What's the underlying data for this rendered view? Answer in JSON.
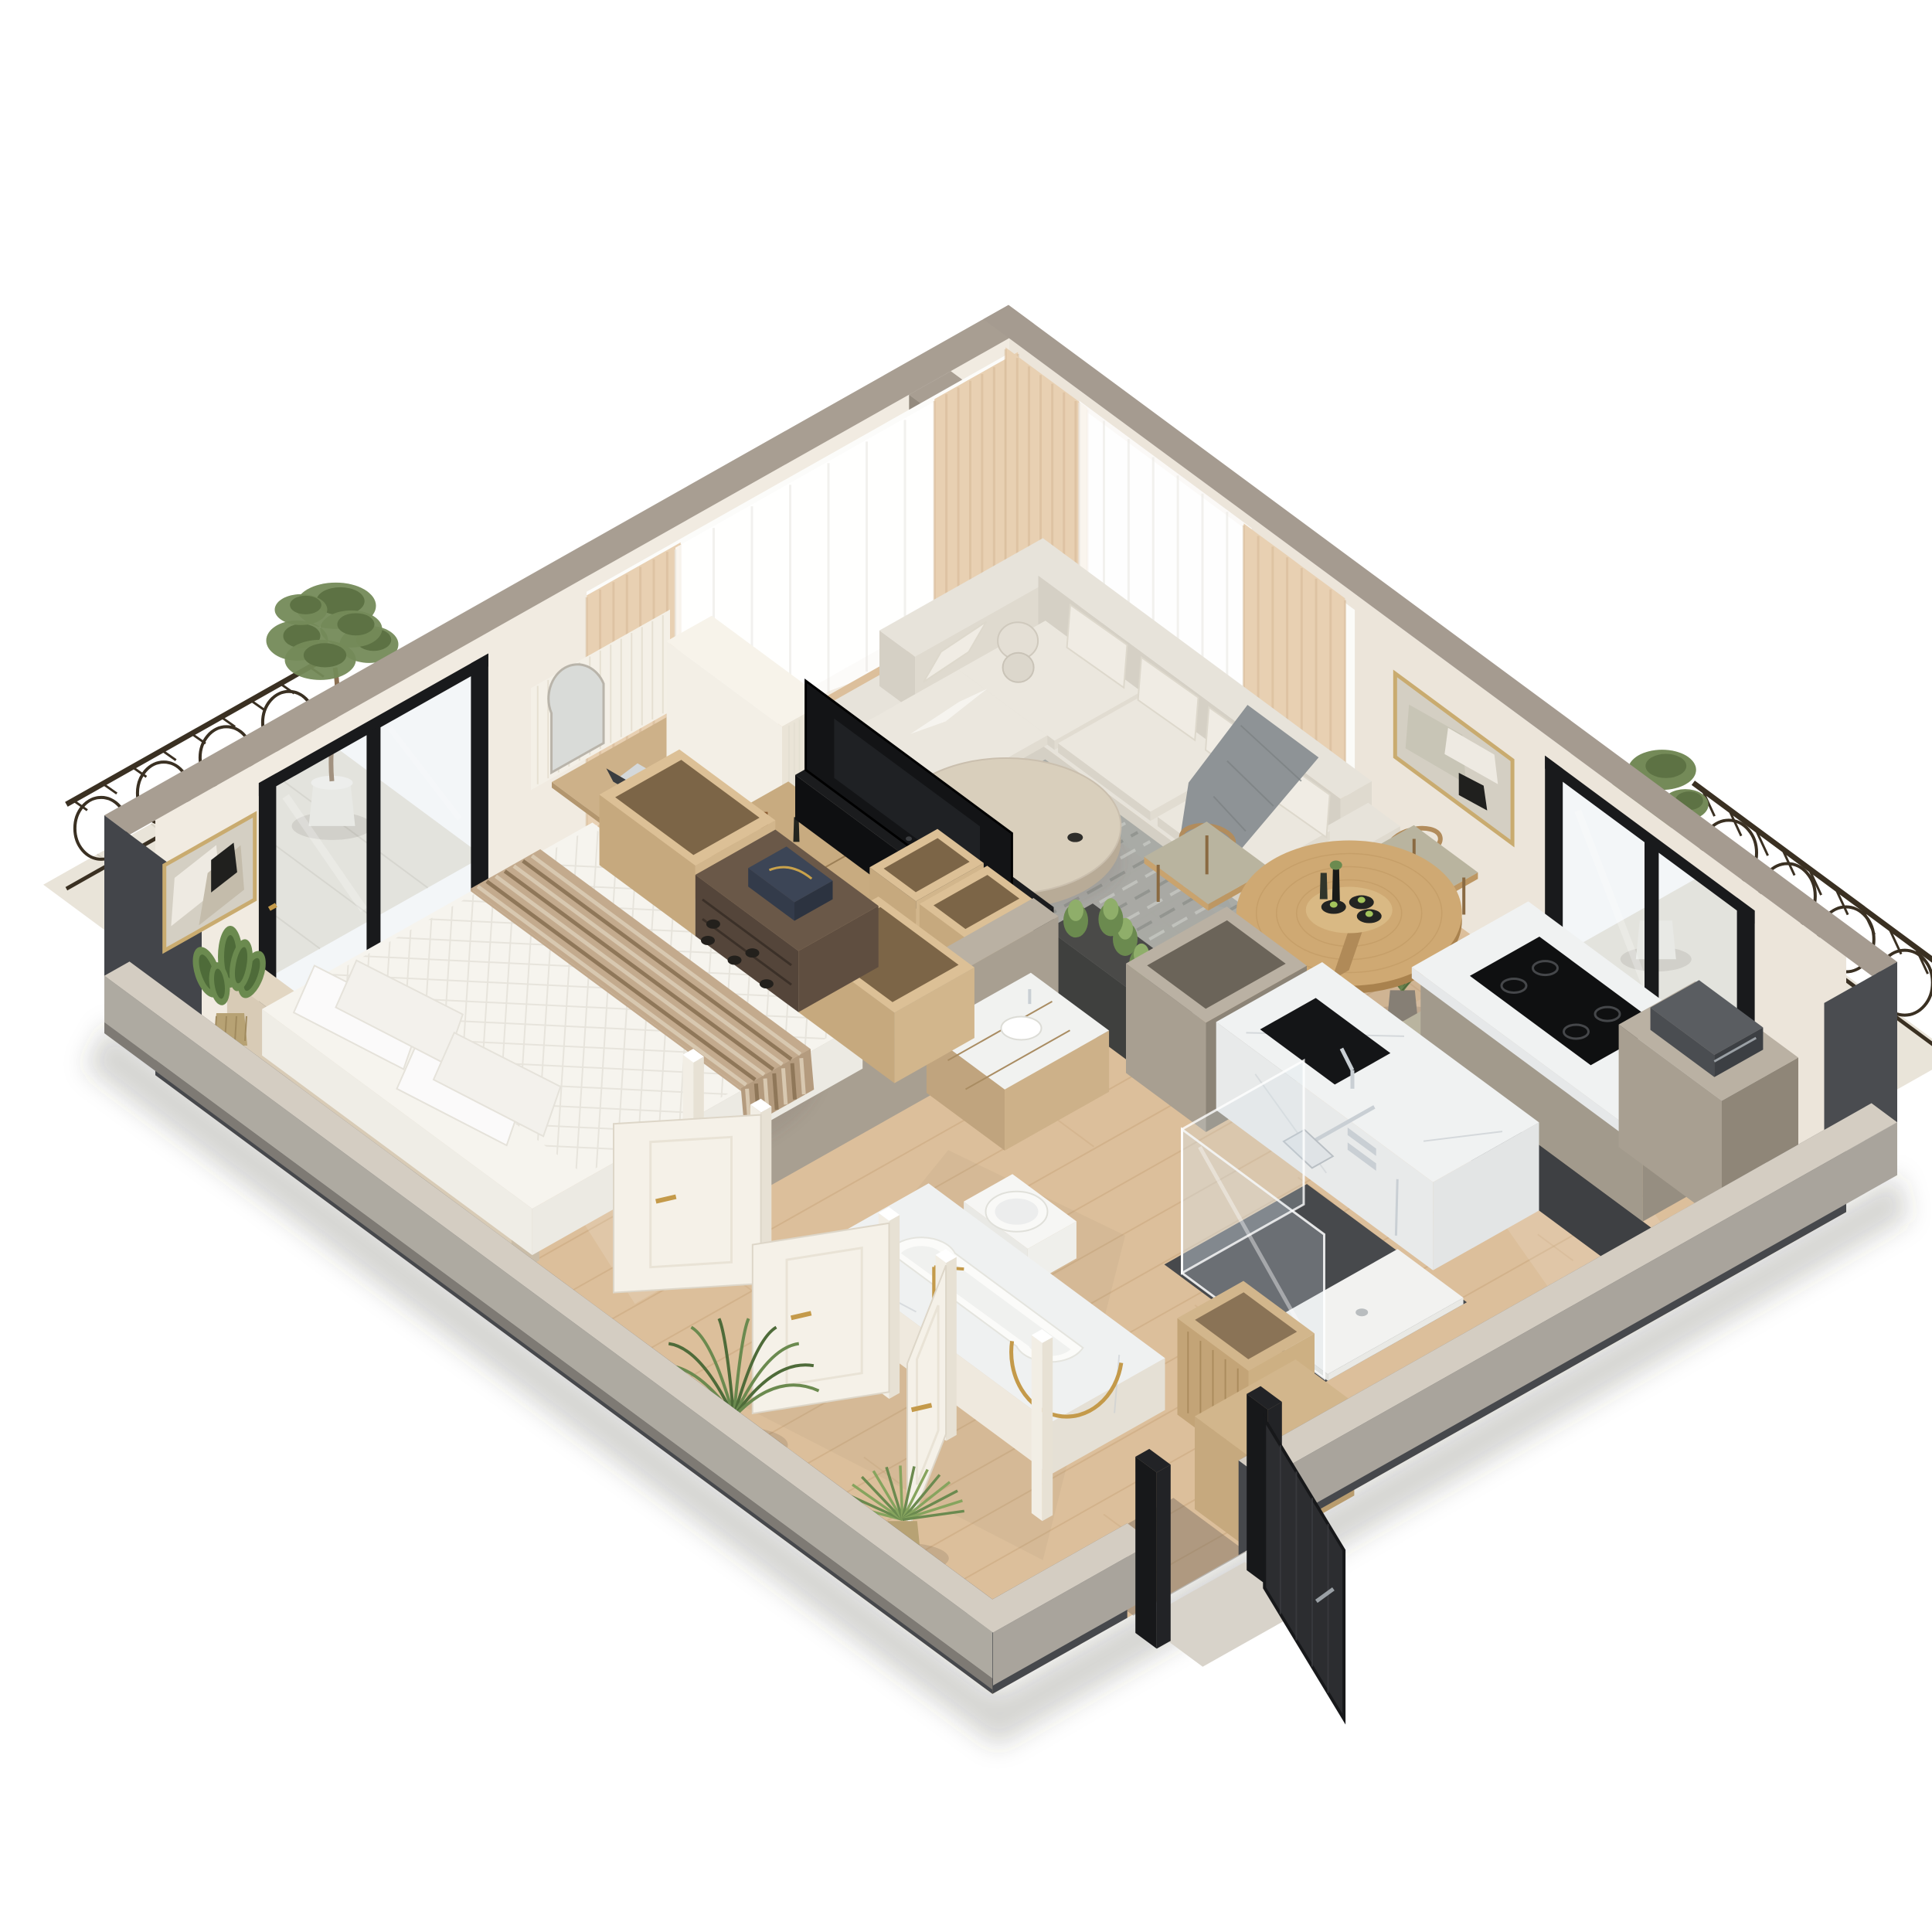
{
  "scene": {
    "title": "3D isometric cutaway floor plan render of a one-bedroom apartment",
    "style": "photoreal architectural visualization, neutral beige palette",
    "background": "#ffffff"
  },
  "palette": {
    "wallTop": "#a89e92",
    "wallInnerNW": "#f1ebe1",
    "wallInnerNE": "#ece5da",
    "wallEndDark": "#43454a",
    "cutInner": "#46484c",
    "cutTop": "#d4cdc2",
    "cutOuter": "#aeaaa1",
    "floor": "#dcbf9b",
    "floorLine": "#c7a379",
    "darkFloor": "#47494c",
    "balconyFloor": "#e9e4d9",
    "railing": "#3a3022",
    "rug": "#a7a9a4",
    "rugStripeA": "#8e918c",
    "rugStripeB": "#c6c8c3",
    "sofaTop": "#e7e3da",
    "sofaFront": "#d5d0c5",
    "sofaSide": "#dfdacf",
    "pillow": "#f0ece4",
    "throw": "#8e9396",
    "travertine": "#d9cfbc",
    "travertineSide": "#b8ab97",
    "woodLight": "#c9ac82",
    "woodMid": "#b69468",
    "woodSide": "#a9895e",
    "woodDark": "#54453a",
    "duvet": "#f6f4ee",
    "duvetSide": "#eceae3",
    "headboard": "#d8cbb6",
    "runnerBase": "#c3aa8d",
    "runnerS1": "#8f7759",
    "runnerS2": "#d8c8b0",
    "doorWhite": "#f5f1e8",
    "doorWhiteShade": "#e9e3d6",
    "gold": "#c49a4a",
    "frameBlack": "#191a1c",
    "glassTint": "rgba(214,226,233,0.30)",
    "marbleTop": "#f0f2f2",
    "marbleFace": "#e6e8e9",
    "vein": "#c9ced2",
    "taupeLight": "#a89f91",
    "taupeDark": "#8f8678",
    "taupeTop": "#bab1a3",
    "ceramic": "#f9f9f7",
    "chrome": "#c9cfd4",
    "greenD": "#4e6b39",
    "greenM": "#6b8a4f",
    "greenL": "#8fae6a",
    "planterDark": "#3f403e",
    "tvBlack": "#131416",
    "artBg": "#d4cfc3",
    "artBeige": "#c4bcab",
    "artWhite": "#eeeae2",
    "artBlack": "#20201e",
    "curtainBeige": "#e8d0b2",
    "curtainFold": "#d6ba97",
    "sheerFold": "#e9e7e2",
    "machineDark": "#4a4d51",
    "entryLeaf": "#2c2d30",
    "shadow": "rgba(90,78,64,0.10)"
  },
  "rooms": [
    {
      "id": "bedroom",
      "label": "Bedroom"
    },
    {
      "id": "living-room",
      "label": "Living room"
    },
    {
      "id": "dining-area",
      "label": "Dining area"
    },
    {
      "id": "kitchen",
      "label": "Kitchen"
    },
    {
      "id": "bathroom",
      "label": "Bathroom"
    },
    {
      "id": "entry",
      "label": "Entry"
    },
    {
      "id": "balcony-left",
      "label": "Left balcony"
    },
    {
      "id": "balcony-right",
      "label": "Right balcony"
    }
  ],
  "items": [
    {
      "id": "floor",
      "label": "wood floor"
    },
    {
      "id": "wall-northwest",
      "label": "back-left wall"
    },
    {
      "id": "wall-northeast",
      "label": "back-right wall"
    },
    {
      "id": "cut-wall-southwest",
      "label": "front-left cut wall"
    },
    {
      "id": "cut-wall-southeast",
      "label": "front-right cut wall"
    },
    {
      "id": "art-frame-left",
      "label": "abstract art frame"
    },
    {
      "id": "art-frame-right",
      "label": "abstract art frame"
    },
    {
      "id": "balcony-door-left",
      "label": "black framed balcony door"
    },
    {
      "id": "balcony-door-right",
      "label": "black framed balcony door"
    },
    {
      "id": "curtains-left",
      "label": "beige and sheer curtains"
    },
    {
      "id": "curtains-right",
      "label": "beige and sheer curtains"
    },
    {
      "id": "bed",
      "label": "double bed with striped runner"
    },
    {
      "id": "wardrobe-boxes",
      "label": "open wardrobe boxes and shoe rack"
    },
    {
      "id": "desk",
      "label": "floating desk with laptop and mirror"
    },
    {
      "id": "sideboard",
      "label": "low sideboard with decor"
    },
    {
      "id": "tv-divider",
      "label": "TV room divider"
    },
    {
      "id": "sofa",
      "label": "L-shaped sectional sofa"
    },
    {
      "id": "coffee-table",
      "label": "round travertine coffee table"
    },
    {
      "id": "rug",
      "label": "gray striped rug"
    },
    {
      "id": "dining-set",
      "label": "round dining table with chairs"
    },
    {
      "id": "kitchen-island",
      "label": "marble island with sink"
    },
    {
      "id": "kitchen-counter",
      "label": "marble counter with cooktop"
    },
    {
      "id": "tall-cabinet",
      "label": "tall cabinet with coffee machine"
    },
    {
      "id": "bathtub",
      "label": "bathtub with gold faucet"
    },
    {
      "id": "toilet",
      "label": "wall hung toilet"
    },
    {
      "id": "vanity",
      "label": "wood vanity"
    },
    {
      "id": "shower",
      "label": "glass shower"
    },
    {
      "id": "bathroom-doors",
      "label": "white paneled doors with gold handles"
    },
    {
      "id": "entry-door",
      "label": "dark entry door"
    },
    {
      "id": "plants",
      "label": "potted plants"
    }
  ]
}
